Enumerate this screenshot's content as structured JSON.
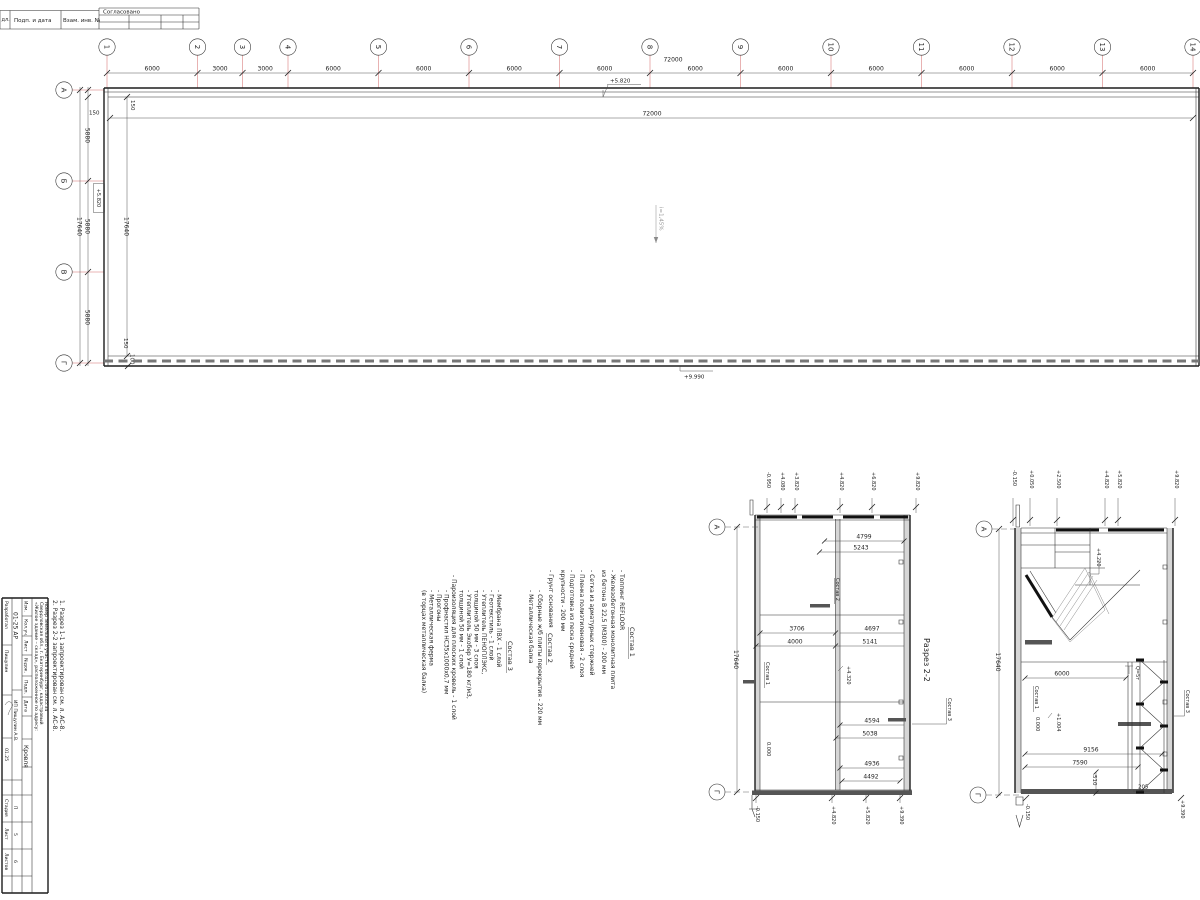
{
  "frame": {
    "inv_col": "дл.",
    "sig_col": "Подп. и дата",
    "vzam_col": "Взам. инв. №",
    "approved": "Согласовано"
  },
  "plan": {
    "axes_h": [
      "1",
      "2",
      "3",
      "4",
      "5",
      "6",
      "7",
      "8",
      "9",
      "10",
      "11",
      "12",
      "13",
      "14"
    ],
    "top_dims": [
      "6000",
      "3000",
      "3000",
      "6000",
      "6000",
      "6000",
      "6000",
      "6000",
      "6000",
      "6000",
      "6000",
      "6000",
      "6000"
    ],
    "total": "72000",
    "total_inner": "72000",
    "axes_v": [
      "А",
      "Б",
      "В",
      "Г"
    ],
    "side_dims": [
      "5880",
      "5880",
      "5880"
    ],
    "side_total": "17640",
    "side_total_inner": "17640",
    "off_top": "150",
    "off_top_rot": "150",
    "off_bottom": "150",
    "off_bottom2": "100",
    "level_top": "+5.820",
    "level_axis_b": "+5.820",
    "level_bottom": "+9.990",
    "slope": "i=1,45%"
  },
  "side_notes": {
    "n1": "1. Разрез 1-1 запроектирован см. л. АС-8.",
    "n2": "2. Разрез 2-2 запроектирован см. л. АС-8."
  },
  "comp": {
    "c1_title": "Состав 1",
    "c1": [
      "- Топпинг REFLOOR",
      "- Железобетонная монолитная плита",
      "  из бетона В 22,5 (М300)        - 200 мм",
      "- Сетка из арматурных стержней",
      "- Пленка полиэтиленовая        - 2 слоя",
      "- Подготовка из песка средней",
      "  крупности        - 200 мм",
      "- Грунт основания"
    ],
    "c2_title": "Состав 2",
    "c2": [
      "- Сборные ж/б плиты перекрытия  - 220 мм",
      "- Металлическая балка"
    ],
    "c3_title": "Состав 3",
    "c3": [
      "- Мембрана ПВХ        - 1 слой",
      "- Геотекстиль        - 1 слой",
      "- Утеплитель ПЕНОПЛЭКС,",
      "  толщиной 50 мм        - 3 слоя",
      "- Утеплитель Экобер У=180 кг/м3,",
      "  толщиной 50 мм        - 1 слой",
      "- Пароизоляция для плоских кровель - 1 слой",
      "- Профнастил НС35х1000х0,7 мм",
      "- Прогоны",
      "- Металлическая ферма",
      "  (в торцах металлическая балка)"
    ]
  },
  "s2": {
    "title": "Разрез 2-2",
    "axA": "А",
    "axG": "Г",
    "h": "17640",
    "dims": [
      "4799",
      "5243",
      "3706",
      "4000",
      "4697",
      "5141",
      "4594",
      "5038",
      "4936",
      "4492"
    ],
    "lt": [
      "-0.950",
      "+4.080",
      "+3.820",
      "+4.820",
      "+6.820",
      "+9.820"
    ],
    "lb": [
      "-0.150",
      "+4.820",
      "+5.820",
      "+9.390"
    ],
    "c1": "Состав 1",
    "c2": "Состав 2",
    "c3": "Состав 3",
    "zero": "0.000",
    "mid": "+4.320"
  },
  "s1": {
    "axA": "А",
    "axG": "Г",
    "h": "17640",
    "d6000": "6000",
    "d9156": "9156",
    "d7590": "7590",
    "d510": "510",
    "d205": "205",
    "lt": [
      "-0.150",
      "+0.050",
      "+2.500",
      "+4.820",
      "+5.820",
      "+9.820"
    ],
    "lb": [
      "-0.150",
      "+9.390"
    ],
    "stair": "+4.220",
    "zero": "0.000",
    "mid": "+1.004",
    "crane": "Q=5т",
    "c1": "Состав 1",
    "c3": "Состав 3"
  },
  "stamp": {
    "h1": "Изм.",
    "h2": "Кол.уч.",
    "h3": "Лист",
    "h4": "№док.",
    "h5": "Подп.",
    "h6": "Дата",
    "role1": "Разработал",
    "name1": "Пищулин",
    "date1": "01.25",
    "doc_no": "01-25 АР",
    "sheet_name": "Кровля",
    "project1": "«Жилое здание – склад», расположенное по адресу:",
    "project2": "Свердловская обл., г. Екатеринбург, кадастровый",
    "project3": "номер земельного участка 66:41:0614035:34",
    "stage_h": "Стадия",
    "list_h": "Лист",
    "lists_h": "Листов",
    "stage": "П",
    "list": "5",
    "lists": "6",
    "company": "ИП Пищулин А.В."
  }
}
